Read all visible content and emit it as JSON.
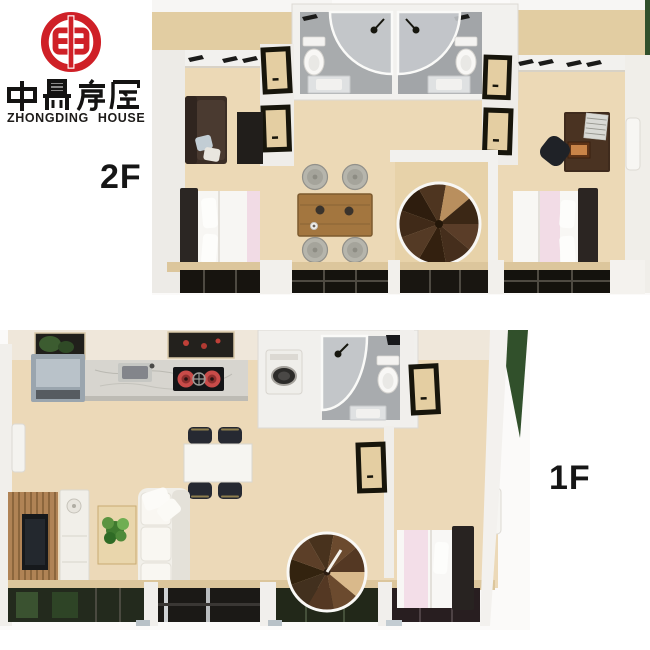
{
  "brand": {
    "chinese_name": "中鼎房屋",
    "english_name": "ZHONGDING HOUSE",
    "logo_color": "#cf2027",
    "text_color": "#1d1b19"
  },
  "floors": {
    "upper": {
      "label": "2F",
      "rooms": [
        "left-bedroom-with-sofa",
        "bathroom-left",
        "bathroom-right",
        "dining-tea-area",
        "stairwell",
        "right-bedroom-with-desk",
        "front-balcony"
      ],
      "furniture": [
        "dark-sofa",
        "tv-panel",
        "double-bed-left",
        "toilet",
        "corner-shower",
        "washbasin",
        "wood-dining-table",
        "round-stools-x4",
        "spiral-staircase",
        "writing-desk",
        "desk-chair",
        "book-stack",
        "photo-frame",
        "double-bed-right",
        "wall-air-conditioner",
        "ceiling-vents"
      ]
    },
    "lower": {
      "label": "1F",
      "rooms": [
        "kitchen",
        "dining-area",
        "living-room",
        "bathroom",
        "bedroom",
        "stairwell",
        "glazed-deck"
      ],
      "furniture": [
        "range-hood",
        "marble-counter",
        "kitchen-sink",
        "gas-stove",
        "white-dining-table",
        "dining-chairs-x4",
        "wall-water-heater",
        "slat-tv-wall",
        "television",
        "white-sideboard",
        "coffee-table",
        "green-plant",
        "white-sofa",
        "washing-machine",
        "toilet",
        "corner-shower",
        "washbasin",
        "spiral-staircase",
        "double-bed",
        "wall-air-conditioner"
      ]
    }
  },
  "palette": {
    "background": "#ffffff",
    "wood_floor": "#ecd9b6",
    "loft_wood": "#e2cda2",
    "wall_white": "#f2f1ee",
    "bathroom_floor_gray": "#a8abad",
    "dark_furniture": "#3b2e26",
    "bed_white": "#f8f7f4",
    "bed_pink": "#f2dce6",
    "stair_brown": "#4e3520",
    "stool_gray": "#b6b5ac",
    "table_wood": "#a3763f",
    "counter_marble": "#d7d5cf",
    "stove_red": "#c84b49",
    "chair_dark_navy": "#262932",
    "slat_wall_wood": "#b08355",
    "plant_green": "#4f8a3a",
    "glass_dark": "#17140f",
    "glass_green": "#3a5230",
    "grass_green": "#31502b",
    "sill_wood": "#dcc69c"
  }
}
